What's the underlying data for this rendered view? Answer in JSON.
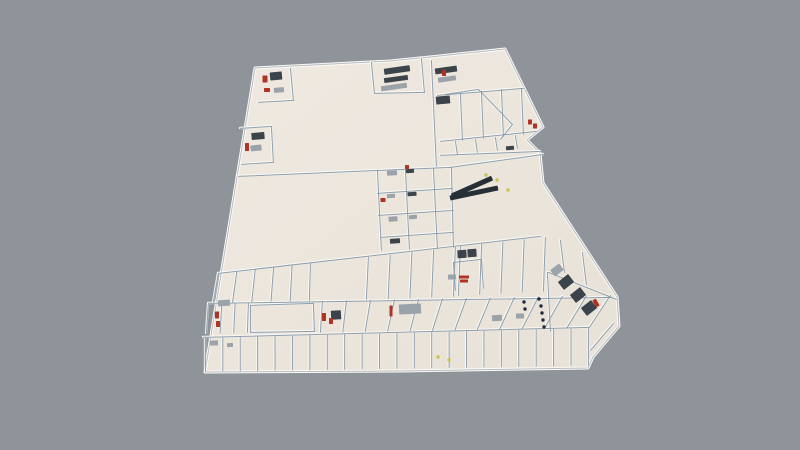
{
  "canvas": {
    "width": 800,
    "height": 450,
    "background": "#8f949a"
  },
  "palette": {
    "floor_light": "#efe9e1",
    "floor_dark": "#e8e1d7",
    "ridge": "#fbfaf6",
    "outline_edge": "#b7bcc1",
    "wall": "#8799a8",
    "furniture_dark": "#3c444b",
    "furniture_gray": "#9aa3aa",
    "accent_red": "#b03425",
    "accent_yellow": "#c8c44e",
    "accent_navy": "#222c3e",
    "escalator": "#272f36"
  },
  "scene": {
    "outline": [
      [
        255,
        68
      ],
      [
        390,
        61
      ],
      [
        430,
        57
      ],
      [
        505,
        49
      ],
      [
        543,
        127
      ],
      [
        527,
        140
      ],
      [
        540,
        153
      ],
      [
        543,
        183
      ],
      [
        617,
        297
      ],
      [
        619,
        326
      ],
      [
        593,
        357
      ],
      [
        588,
        368
      ],
      [
        400,
        371
      ],
      [
        205,
        372
      ]
    ],
    "walls": [
      [
        238,
        176,
        450,
        167
      ],
      [
        431,
        60,
        436,
        166
      ],
      [
        290,
        68,
        293,
        100
      ],
      [
        258,
        102,
        293,
        100
      ],
      [
        240,
        128,
        271,
        126
      ],
      [
        271,
        126,
        273,
        162
      ],
      [
        241,
        164,
        273,
        162
      ],
      [
        371,
        62,
        374,
        93
      ],
      [
        421,
        58,
        424,
        92
      ],
      [
        374,
        93,
        424,
        92
      ],
      [
        437,
        95,
        523,
        88
      ],
      [
        440,
        141,
        536,
        131
      ],
      [
        460,
        93,
        462,
        140
      ],
      [
        481,
        91,
        483,
        138
      ],
      [
        501,
        89,
        503,
        136
      ],
      [
        521,
        88,
        523,
        134
      ],
      [
        445,
        94,
        478,
        89
      ],
      [
        478,
        89,
        512,
        124
      ],
      [
        512,
        124,
        500,
        139
      ],
      [
        455,
        141,
        457,
        154
      ],
      [
        475,
        139,
        477,
        152
      ],
      [
        495,
        137,
        497,
        150
      ],
      [
        515,
        135,
        517,
        148
      ],
      [
        440,
        155,
        540,
        151
      ],
      [
        450,
        167,
        543,
        154
      ],
      [
        377,
        170,
        381,
        250
      ],
      [
        405,
        169,
        409,
        249
      ],
      [
        433,
        168,
        437,
        248
      ],
      [
        451,
        167,
        453,
        247
      ],
      [
        377,
        193,
        452,
        188
      ],
      [
        378,
        215,
        453,
        210
      ],
      [
        380,
        237,
        453,
        232
      ],
      [
        218,
        273,
        540,
        236
      ],
      [
        208,
        303,
        612,
        297
      ],
      [
        203,
        337,
        589,
        327
      ],
      [
        250,
        305,
        313,
        303
      ],
      [
        250,
        305,
        250,
        332
      ],
      [
        313,
        303,
        314,
        331
      ],
      [
        250,
        332,
        314,
        331
      ],
      [
        453,
        262,
        481,
        259
      ],
      [
        453,
        262,
        455,
        290
      ],
      [
        481,
        259,
        483,
        288
      ],
      [
        548,
        272,
        616,
        299
      ],
      [
        547,
        272,
        550,
        331
      ],
      [
        590,
        350,
        613,
        323
      ],
      [
        560,
        240,
        564,
        272
      ],
      [
        582,
        252,
        586,
        284
      ]
    ],
    "fences": [
      {
        "top": [
          205,
          338,
          588,
          328
        ],
        "bottom": [
          205,
          371,
          588,
          365
        ],
        "n": 22
      },
      {
        "top": [
          208,
          304,
          248,
          303
        ],
        "bottom": [
          206,
          333,
          247,
          332
        ],
        "n": 3
      },
      {
        "top": [
          322,
          301,
          610,
          295
        ],
        "bottom": [
          320,
          332,
          589,
          327
        ],
        "n": 12
      },
      {
        "top": [
          218,
          273,
          310,
          263
        ],
        "bottom": [
          213,
          302,
          309,
          300
        ],
        "n": 5
      },
      {
        "top": [
          368,
          257,
          455,
          247
        ],
        "bottom": [
          366,
          299,
          453,
          296
        ],
        "n": 4
      },
      {
        "top": [
          460,
          246,
          545,
          237
        ],
        "bottom": [
          458,
          295,
          543,
          291
        ],
        "n": 4
      }
    ],
    "items": [
      [
        397,
        70,
        26,
        6,
        -8,
        "dark"
      ],
      [
        396,
        79,
        24,
        5,
        -8,
        "dark"
      ],
      [
        394,
        87,
        26,
        5,
        -8,
        "gray"
      ],
      [
        446,
        70,
        22,
        6,
        -8,
        "dark"
      ],
      [
        447,
        79,
        18,
        5,
        -8,
        "gray"
      ],
      [
        443,
        100,
        14,
        8,
        -5,
        "dark"
      ],
      [
        444,
        73,
        4,
        6,
        0,
        "red"
      ],
      [
        276,
        76,
        12,
        8,
        -5,
        "dark"
      ],
      [
        265,
        79,
        5,
        7,
        0,
        "red"
      ],
      [
        267,
        90,
        6,
        4,
        0,
        "red"
      ],
      [
        279,
        90,
        10,
        5,
        -5,
        "gray"
      ],
      [
        258,
        136,
        13,
        7,
        -5,
        "dark"
      ],
      [
        256,
        148,
        11,
        6,
        -5,
        "gray"
      ],
      [
        247,
        147,
        4,
        8,
        0,
        "red"
      ],
      [
        224,
        303,
        12,
        6,
        -4,
        "gray"
      ],
      [
        217,
        315,
        4,
        7,
        0,
        "red"
      ],
      [
        218,
        324,
        4,
        6,
        0,
        "red"
      ],
      [
        392,
        173,
        10,
        5,
        -4,
        "gray"
      ],
      [
        410,
        171,
        8,
        4,
        -4,
        "dark"
      ],
      [
        391,
        196,
        8,
        4,
        -4,
        "gray"
      ],
      [
        383,
        200,
        5,
        4,
        0,
        "red"
      ],
      [
        412,
        194,
        9,
        4,
        -4,
        "dark"
      ],
      [
        393,
        219,
        9,
        5,
        -4,
        "gray"
      ],
      [
        413,
        217,
        8,
        4,
        -4,
        "gray"
      ],
      [
        395,
        241,
        10,
        5,
        -4,
        "dark"
      ],
      [
        407,
        167,
        4,
        4,
        0,
        "red"
      ],
      [
        472,
        187,
        44,
        5,
        -24,
        "esc"
      ],
      [
        474,
        193,
        49,
        5,
        -12,
        "esc"
      ],
      [
        410,
        309,
        22,
        10,
        -3,
        "gray"
      ],
      [
        391,
        311,
        3,
        11,
        0,
        "red"
      ],
      [
        336,
        315,
        10,
        9,
        -3,
        "dark"
      ],
      [
        324,
        317,
        4,
        8,
        0,
        "red"
      ],
      [
        331,
        321,
        4,
        6,
        0,
        "red"
      ],
      [
        462,
        254,
        9,
        8,
        -3,
        "dark"
      ],
      [
        472,
        253,
        9,
        8,
        -3,
        "dark"
      ],
      [
        464,
        277,
        10,
        3,
        0,
        "red"
      ],
      [
        464,
        281,
        8,
        3,
        0,
        "red"
      ],
      [
        452,
        277,
        8,
        5,
        -3,
        "gray"
      ],
      [
        530,
        122,
        4,
        5,
        0,
        "red"
      ],
      [
        535,
        126,
        4,
        5,
        0,
        "red"
      ],
      [
        510,
        148,
        8,
        4,
        -4,
        "dark"
      ],
      [
        557,
        270,
        11,
        8,
        -38,
        "gray"
      ],
      [
        566,
        282,
        13,
        10,
        -38,
        "dark"
      ],
      [
        578,
        295,
        13,
        10,
        -38,
        "dark"
      ],
      [
        589,
        308,
        13,
        10,
        -38,
        "dark"
      ],
      [
        596,
        303,
        4,
        8,
        -30,
        "red"
      ],
      [
        497,
        318,
        10,
        6,
        -3,
        "gray"
      ],
      [
        520,
        316,
        8,
        5,
        -3,
        "gray"
      ],
      [
        214,
        343,
        8,
        5,
        -3,
        "gray"
      ],
      [
        230,
        345,
        6,
        4,
        -3,
        "gray"
      ]
    ],
    "dots": [
      [
        486,
        175,
        "yellow"
      ],
      [
        497,
        180,
        "yellow"
      ],
      [
        508,
        190,
        "yellow"
      ],
      [
        438,
        357,
        "yellow"
      ],
      [
        449,
        360,
        "yellow"
      ],
      [
        539,
        299,
        "navy"
      ],
      [
        541,
        306,
        "navy"
      ],
      [
        542,
        313,
        "navy"
      ],
      [
        543,
        320,
        "navy"
      ],
      [
        544,
        327,
        "navy"
      ],
      [
        524,
        302,
        "navy"
      ],
      [
        525,
        309,
        "navy"
      ]
    ]
  }
}
